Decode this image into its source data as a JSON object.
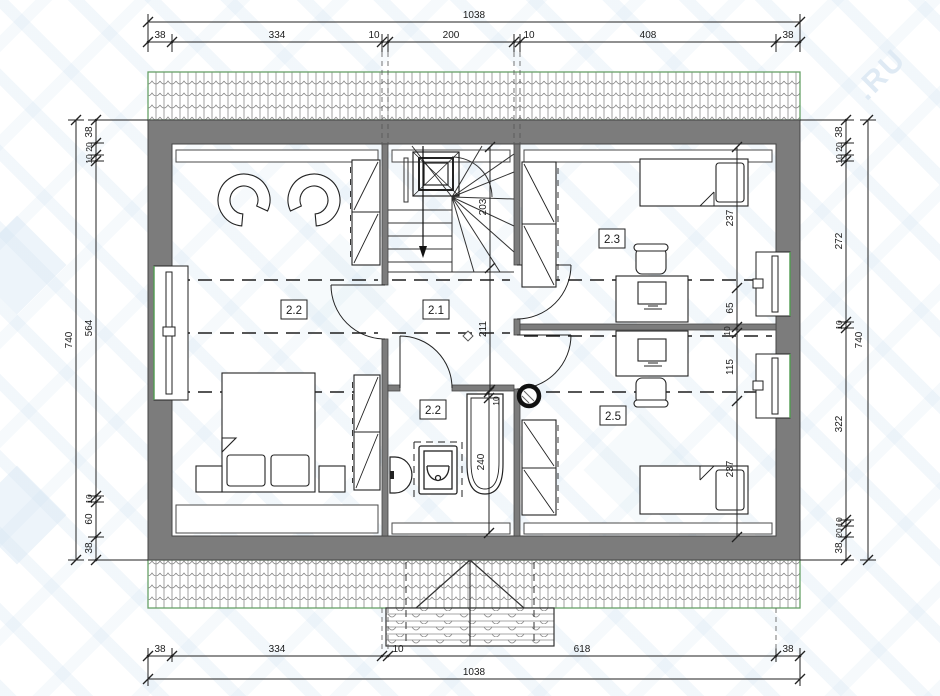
{
  "watermark": {
    "fragment": ".RU"
  },
  "rooms": {
    "hall": "2.1",
    "bedroom_left": "2.2",
    "bedroom_top_right": "2.3",
    "bathroom": "2.2",
    "bedroom_bottom_right": "2.5"
  },
  "dims": {
    "top": {
      "total": "1038",
      "segments": [
        "38",
        "334",
        "10",
        "200",
        "10",
        "408",
        "38"
      ]
    },
    "bottom": {
      "total": "1038",
      "segments": [
        "38",
        "334",
        "10",
        "618",
        "38"
      ]
    },
    "left": {
      "total": "740",
      "segments": [
        "38",
        "20",
        "10",
        "564",
        "10",
        "60",
        "38"
      ]
    },
    "right": {
      "total": "740",
      "segments": [
        "38",
        "20",
        "10",
        "272",
        "10",
        "322",
        "10",
        "20",
        "38"
      ]
    },
    "interior_right": [
      "237",
      "65",
      "10",
      "115",
      "237"
    ],
    "interior_center": {
      "stair": "203",
      "hall": "211",
      "tub_offset": "10",
      "bath": "240"
    }
  }
}
